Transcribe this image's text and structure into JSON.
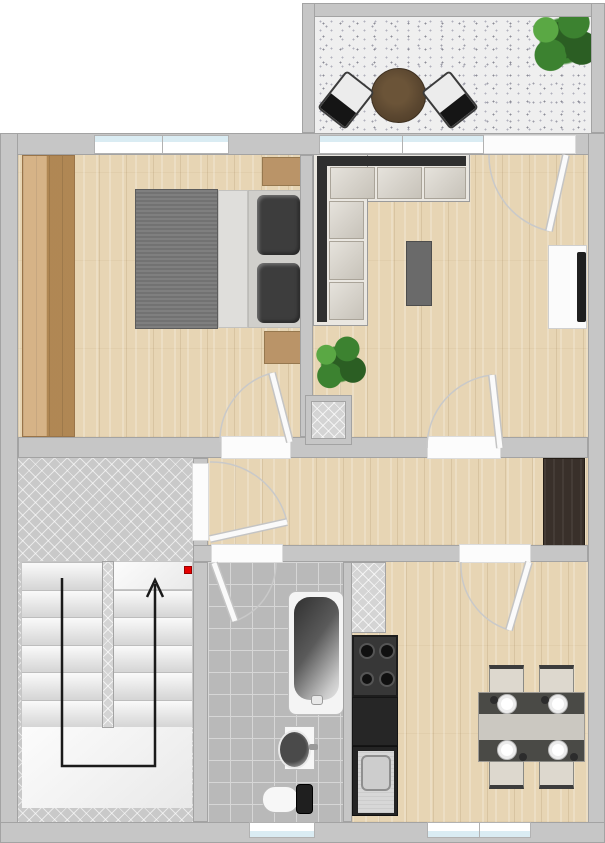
{
  "meta": {
    "kind": "apartment floor plan, top-down 2D render",
    "width_px": 605,
    "height_px": 843,
    "visible_text": "none"
  },
  "colors": {
    "wall": "#c6c6c6",
    "wall_edge": "#a3a3a3",
    "wood": "#e7d5b4",
    "wardrobe": "#c89a5f",
    "nightstand": "#ba9468",
    "hall_closet": "#39302a",
    "tile": "#c9c9c9",
    "bath_tile": "#b9b9b9",
    "bath_line": "#d6d6d6",
    "terrace": "#efefef",
    "speckle": "#8b8b96",
    "glass": "#daecf3",
    "window_frame": "#b2b2b2",
    "door_leaf": "#fafafa",
    "door_arc": "#c9c9c9",
    "sofa_frame": "#eae7e1",
    "sofa_back": "#2f2f2f",
    "sofa_cushion": "#d8d3c9",
    "bed_blanket": "#787878",
    "mattress": "#dfdedb",
    "pillow_base": "#d0cfcb",
    "pillow": "#3d3d3d",
    "coffee_table": "#6a6a6a",
    "tv_board": "#fbfbfb",
    "tv": "#1f1f1f",
    "balcony_table": "#5b4730",
    "chair_black": "#151515",
    "chair_white": "#ececec",
    "chair_beige": "#ddd8ce",
    "dining_table": "#cbc8c1",
    "runner": "#4a4a46",
    "plant_dark": "#2b5e23",
    "plant_mid": "#3c8230",
    "plant_light": "#5aa844",
    "stove": "#373737",
    "burner": "#101010",
    "counter": "#262626",
    "steel": "#d7d7d7",
    "tub_rim": "#f4f4f4",
    "tub_dark": "#303030",
    "ceramic": "#f7f7f7",
    "marker_red": "#e60000",
    "arrow": "#1a1a1a"
  },
  "rooms": [
    {
      "id": "balcony",
      "features": [
        "speckled terrace floor",
        "round table",
        "2 patio chairs",
        "potted plant"
      ]
    },
    {
      "id": "bedroom",
      "features": [
        "double bed",
        "2 pillows",
        "2 nightstands",
        "full-height wardrobe",
        "window",
        "door to hallway"
      ]
    },
    {
      "id": "living-room",
      "features": [
        "L-shaped sofa",
        "coffee table",
        "tv sideboard",
        "potted plant",
        "window",
        "balcony door",
        "door to hallway"
      ]
    },
    {
      "id": "hallway",
      "features": [
        "entrance door",
        "dark closet",
        "doors to all rooms"
      ]
    },
    {
      "id": "stairwell",
      "features": [
        "two stair flights",
        "up-direction arrow",
        "red marker",
        "herringbone tiled landing"
      ]
    },
    {
      "id": "bathroom",
      "features": [
        "bathtub",
        "washbasin",
        "toilet",
        "window",
        "tiled floor"
      ]
    },
    {
      "id": "kitchen",
      "features": [
        "gas hob",
        "dark worktop",
        "stainless sink",
        "dining table with 4 chairs and place settings",
        "window",
        "service shaft"
      ]
    }
  ],
  "symbols": {
    "stair_arrow_direction": "up",
    "door_count": 6,
    "window_count": 4,
    "shaft_count": 2
  }
}
